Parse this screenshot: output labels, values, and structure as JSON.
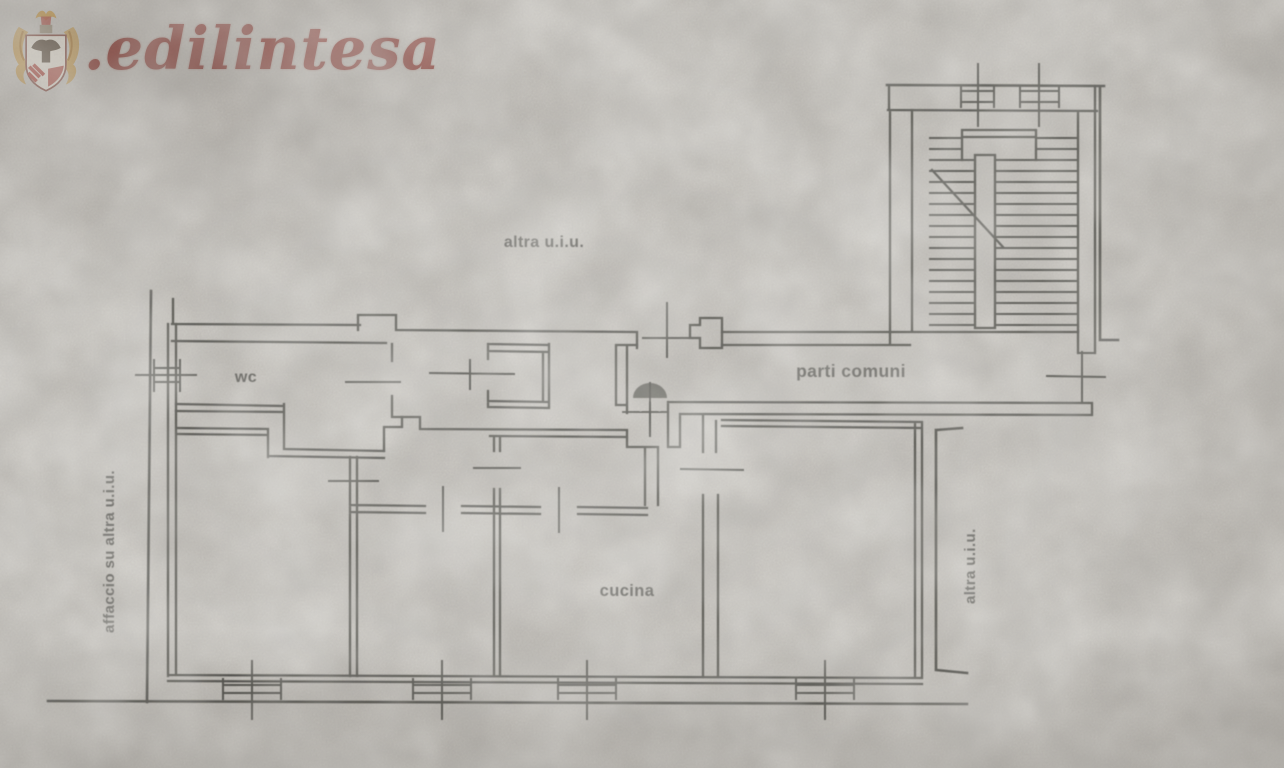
{
  "page": {
    "paper_color": "#c9c6c0",
    "ink_color": "#3e3d39"
  },
  "logo": {
    "text": ".edilintesa",
    "color": "#91413a",
    "crest_gold": "#c7953d",
    "crest_red": "#ab3a2e"
  },
  "plan": {
    "labels": {
      "other_unit_top": "altra u.i.u.",
      "wc": "wc",
      "common_parts": "parti comuni",
      "kitchen": "cucina",
      "facing_other_unit": "affaccio su altra u.i.u.",
      "other_unit_right": "altra u.i.u."
    }
  }
}
